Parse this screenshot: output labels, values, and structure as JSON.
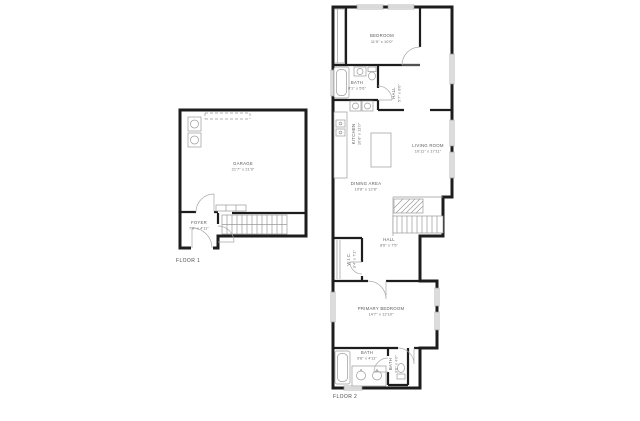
{
  "document": {
    "type": "residential floor plan, two floors, black walls on white background"
  },
  "colors": {
    "wall": "#1d1d1d",
    "fixture_line": "#9a9a9a",
    "label_text": "#5a5a5a",
    "background": "#ffffff"
  },
  "floor1": {
    "label": "FLOOR 1",
    "rooms": {
      "garage": {
        "name": "GARAGE",
        "dims": "21'7\" x 21'9\""
      },
      "foyer": {
        "name": "FOYER",
        "dims": "7'0\" x 4'11\""
      }
    }
  },
  "floor2": {
    "label": "FLOOR 2",
    "rooms": {
      "bedroom": {
        "name": "BEDROOM",
        "dims": "11'5\" x 10'0\""
      },
      "bath_upper": {
        "name": "BATH",
        "dims": "8'1\" x 5'6\""
      },
      "hall_upper": {
        "name": "HALL",
        "dims": "5'7\" x 8'6\""
      },
      "kitchen": {
        "name": "KITCHEN",
        "dims": "10'8\" x 11'0\""
      },
      "living_room": {
        "name": "LIVING ROOM",
        "dims": "10'11\" x 17'11\""
      },
      "dining_area": {
        "name": "DINING AREA",
        "dims": "10'8\" x 12'8\""
      },
      "hall_middle": {
        "name": "HALL",
        "dims": "8'6\" x 7'5\""
      },
      "wic": {
        "name": "W.I.C.",
        "dims": "3'4\" x 7'1\""
      },
      "primary_bedroom": {
        "name": "PRIMARY BEDROOM",
        "dims": "14'7\" x 12'10\""
      },
      "bath_lower": {
        "name": "BATH",
        "dims": "9'6\" x 4'11\""
      },
      "bath_wc": {
        "name": "BATH",
        "dims": "3'6\" x 4'0\""
      }
    }
  }
}
